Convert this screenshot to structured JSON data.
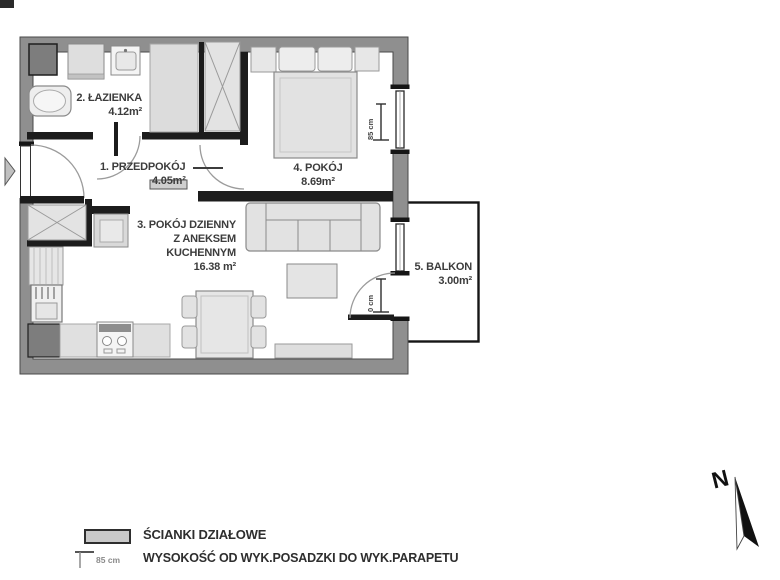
{
  "rooms": {
    "hall": {
      "label": "1. PRZEDPOKÓJ",
      "area": "4.05m²"
    },
    "bathroom": {
      "label": "2. ŁAZIENKA",
      "area": "4.12m²"
    },
    "living": {
      "line1": "3. POKÓJ DZIENNY",
      "line2": "Z ANEKSEM",
      "line3": "KUCHENNYM",
      "area": "16.38 m²"
    },
    "bedroom": {
      "label": "4. POKÓJ",
      "area": "8.69m²"
    },
    "balcony": {
      "label": "5. BALKON",
      "area": "3.00m²"
    }
  },
  "dimensions": {
    "bedroom_window_sill": "85 cm",
    "balcony_door_sill": "0 cm"
  },
  "legend": {
    "partition_label": "ŚCIANKI DZIAŁOWE",
    "height_value": "85 cm",
    "height_label": "WYSOKOŚĆ OD WYK.POSADZKI DO WYK.PARAPETU"
  },
  "compass": {
    "north_label": "N"
  },
  "colors": {
    "outer_wall": "#8f8f8f",
    "partition_wall": "#1c1c1c",
    "furniture_fill": "#e3e3e3",
    "furniture_stroke": "#8a8a8a",
    "appliance_dark": "#7d7d7d",
    "label_text": "#3c3c3c"
  }
}
